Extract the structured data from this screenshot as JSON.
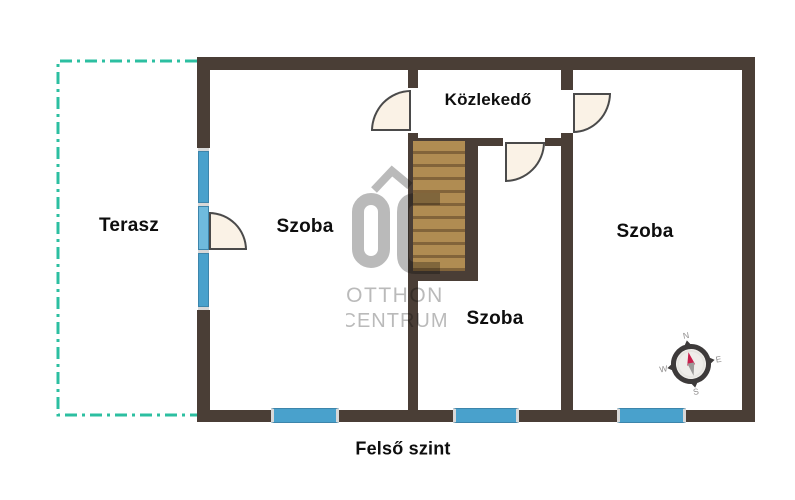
{
  "floorplan": {
    "title": "Felső szint",
    "rooms": {
      "terasz": "Terasz",
      "szoba_left": "Szoba",
      "kozlekedo": "Közlekedő",
      "szoba_middle": "Szoba",
      "szoba_right": "Szoba"
    },
    "watermark": {
      "brand_line1": "OTTHON",
      "brand_line2": "CENTRUM"
    },
    "compass": {
      "north": "N",
      "east": "E",
      "south": "S",
      "west": "W"
    },
    "colors": {
      "wall": "#4a3e36",
      "window_glass": "#49a1cc",
      "window_door_leaf": "#6fbadd",
      "door_swing_fill": "#faf2e6",
      "terrace_outline": "#2cbfa1",
      "stairs_wood": "#b08c52",
      "watermark_grey": "#b7b7b7",
      "compass_needle_red": "#c91f4c"
    }
  }
}
